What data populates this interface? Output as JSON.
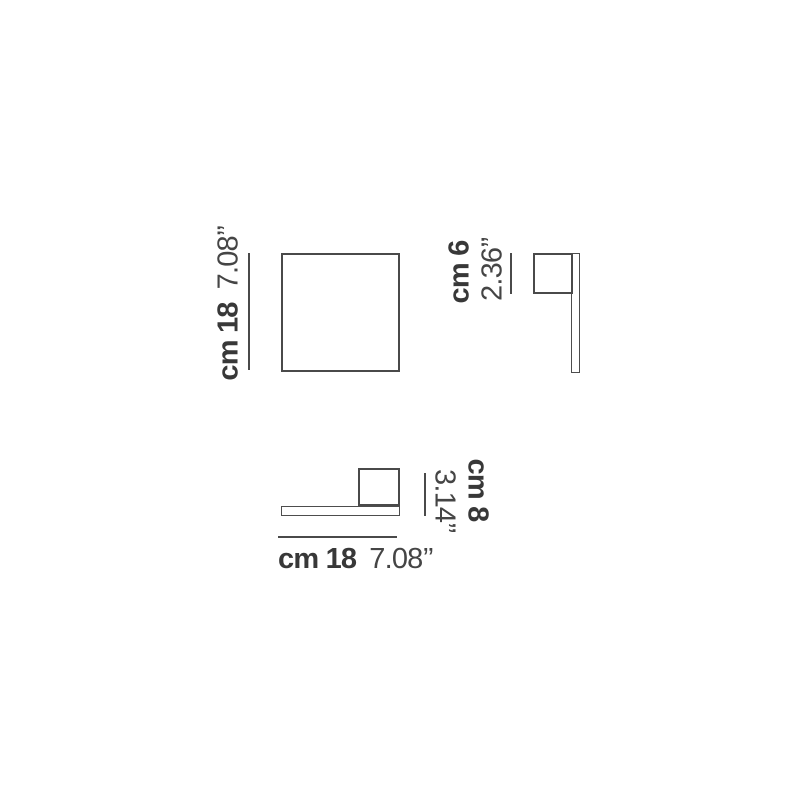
{
  "diagram": {
    "title": "wall-lamp dimension drawing",
    "colors": {
      "background": "#ffffff",
      "line": "#4a4a4a",
      "text": "#3b3b3b"
    },
    "front": {
      "height_metric": "cm 18",
      "height_imperial": "7.08’’"
    },
    "side": {
      "depth_metric": "cm 6",
      "depth_imperial": "2.36’’"
    },
    "plan": {
      "width_metric": "cm 18",
      "width_imperial": "7.08’’",
      "depth_metric": "cm 8",
      "depth_imperial": "3.14’’"
    }
  }
}
